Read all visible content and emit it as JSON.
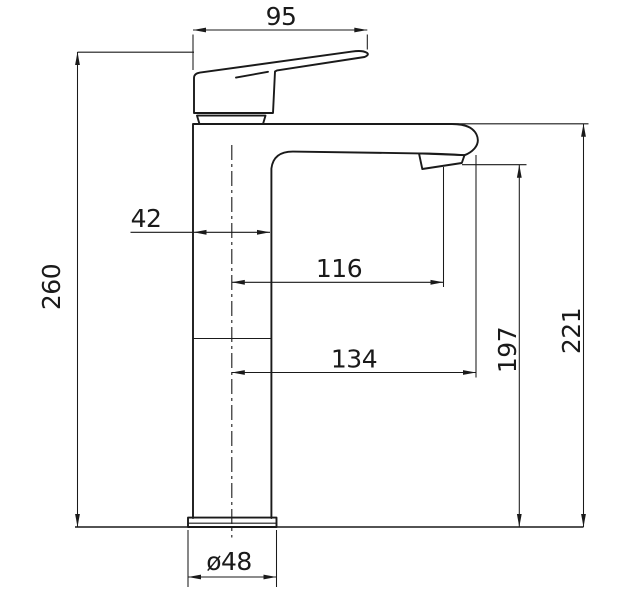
{
  "drawing": {
    "background": "#ffffff",
    "line_color": "#1a1a1a",
    "dimensions": {
      "handle_length_top": "95",
      "overall_height": "260",
      "body_width": "42",
      "reach_to_outlet": "116",
      "reach_to_tip": "134",
      "outlet_height": "197",
      "spout_top_height": "221",
      "base_diameter": "ø48"
    }
  }
}
